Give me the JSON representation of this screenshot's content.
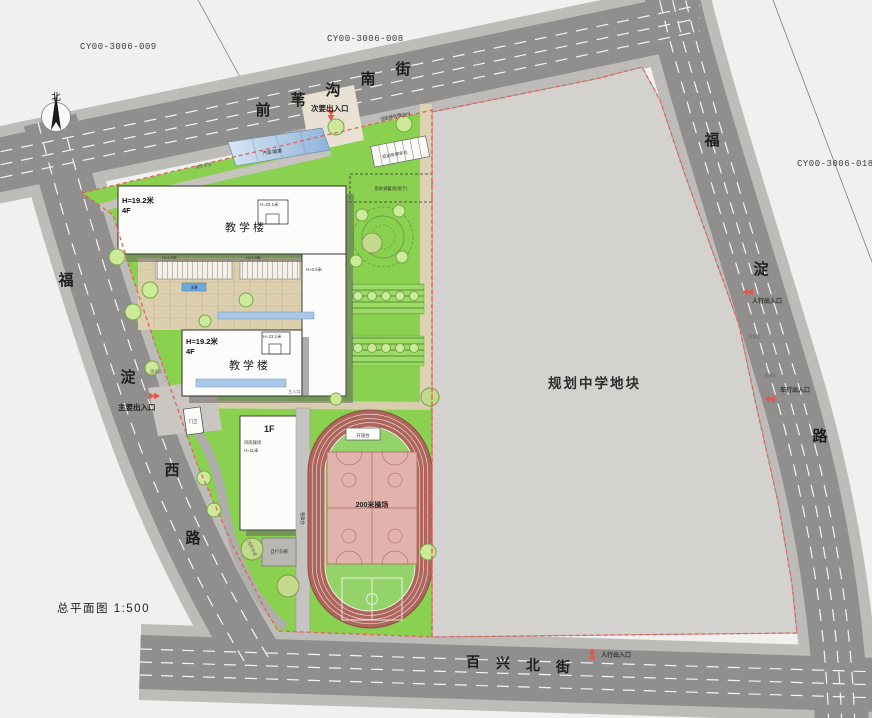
{
  "title": {
    "label": "总平面图 1:500"
  },
  "north": {
    "label": "北"
  },
  "parcels": {
    "top_left": "CY00-3006-009",
    "top_mid": "CY00-3006-008",
    "right": "CY00-3006-018"
  },
  "plot": {
    "label": "规划中学地块"
  },
  "streets": {
    "top": {
      "name": "前苇沟南街",
      "chars": [
        "前",
        "苇",
        "沟",
        "南",
        "街"
      ]
    },
    "left": {
      "name": "福淀西路",
      "chars": [
        "福",
        "淀",
        "西",
        "路"
      ]
    },
    "right": {
      "name": "福淀路",
      "chars": [
        "福",
        "淀",
        "路"
      ]
    },
    "bottom": {
      "name": "百兴北街",
      "chars": [
        "百",
        "兴",
        "北",
        "街"
      ]
    }
  },
  "entrances": {
    "secondary": "次要出入口",
    "main": "主要出入口",
    "ped_right": "人行出入口",
    "veh_right": "车行出入口",
    "ped_bottom": "人行出入口"
  },
  "buildings": {
    "t1_name": "教学楼",
    "t1_h": "H=19.2米",
    "t1_f": "4F",
    "t1_roof": "H=23.1米",
    "t2_name": "教学楼",
    "t2_h": "H=19.2米",
    "t2_f": "4F",
    "t2_roof": "H=23.1米",
    "gym_f": "1F",
    "gym_name": "风雨操场",
    "gym_h": "H=11米",
    "gate": "门卫"
  },
  "grounds": {
    "track": "200米操场",
    "flag": "升旗台",
    "stand": "看操台",
    "ramp": "汽车坡道",
    "parking": "机动车停车位",
    "rain": "雨水调蓄池(地下)",
    "belt": "沿街绿化带(6m)",
    "fire": "消防车道",
    "bike": "自行车棚",
    "drop": "落客区",
    "water": "水景",
    "h05": "H=0.5米",
    "h15": "H=1.5米",
    "main_ent": "主入口"
  },
  "colors": {
    "campus_green": "#8ad14f",
    "plot_gray": "#d3d2cf",
    "road_asphalt": "#908f8d",
    "sidewalk": "#bdbcb9",
    "track_lane": "#ad655c",
    "infield_green": "#93d369",
    "court_pink": "#e2b3ad",
    "boundary_red": "#e2635b",
    "building_white": "#fcfcfa",
    "ramp_blue": "#a9c8e8",
    "paving_tan": "#dccfae"
  }
}
